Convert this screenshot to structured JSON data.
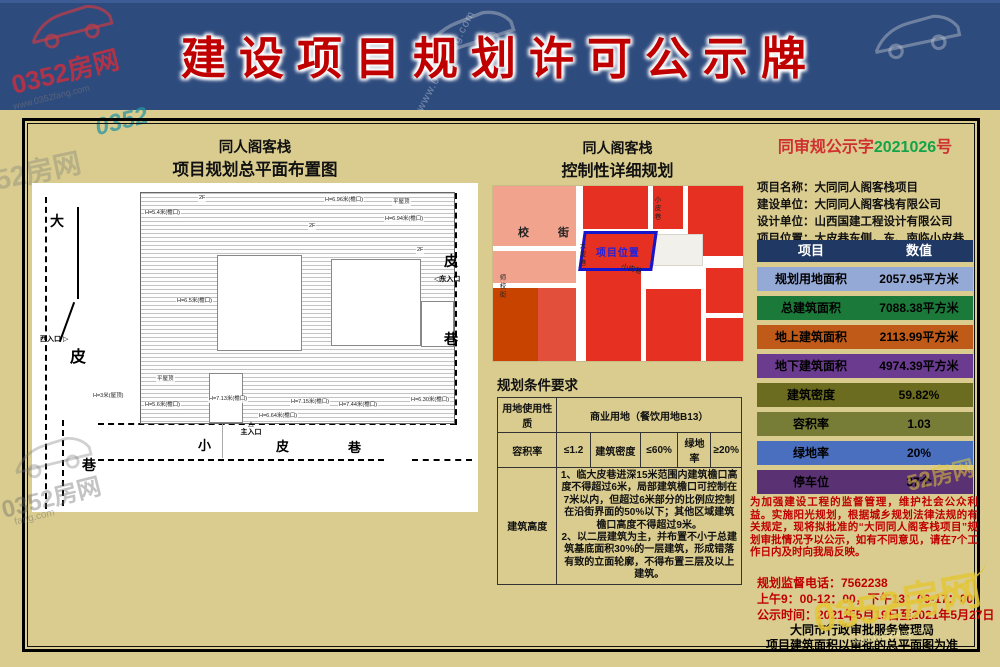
{
  "header": {
    "title": "建设项目规划许可公示牌"
  },
  "watermarks": {
    "brand": "0352房网",
    "domain": "www.0352fang.com",
    "short": "52房网",
    "logo": "0352",
    "suffix": "fang.com"
  },
  "left_panel": {
    "title_line1": "同人阁客栈",
    "title_line2": "项目规划总平面布置图",
    "streets": [
      "大",
      "皮",
      "巷",
      "皮",
      "巷",
      "小",
      "皮",
      "巷"
    ],
    "entrances": {
      "west": "西入口",
      "east": "东入口",
      "main": "主入口"
    },
    "icons": {
      "west_arrow": "▷",
      "east_arrow": "◁",
      "main_arrow": "△"
    },
    "annotations": [
      "H=5.4米(檐口)",
      "H=6.96米(檐口)",
      "H=6.94米(檐口)",
      "2F",
      "2F",
      "2F",
      "平屋顶",
      "平屋顶",
      "H=6.5米(檐口)",
      "H=3米(屋顶)",
      "H=5.6米(檐口)",
      "H=7.13米(檐口)",
      "H=7.15米(檐口)",
      "H=7.44米(檐口)",
      "H=6.30米(檐口)",
      "H=6.64米(檐口)"
    ]
  },
  "mid_panel": {
    "title_line1": "同人阁客栈",
    "title_line2": "控制性详细规划",
    "map_labels": {
      "school_street": "校　街",
      "shixiao_street": "师校街",
      "dapi_lane": "大皮巷",
      "xiaopi_lane_vertical": "小皮巷",
      "xiaopi_lane_diagonal": "小皮巷",
      "project_location": "项目位置"
    },
    "cond": {
      "title": "规划条件要求",
      "row1_label": "用地使用性质",
      "row1_value": "商业用地（餐饮用地B13）",
      "row2": [
        "容积率",
        "≤1.2",
        "建筑密度",
        "≤60%",
        "绿地率",
        "≥20%"
      ],
      "row3_label": "建筑高度",
      "row3_text": "1、临大皮巷进深15米范围内建筑檐口高度不得超过6米，局部建筑檐口可控制在7米以内，但超过6米部分的比例应控制在沿街界面的50%以下；其他区域建筑檐口高度不得超过9米。\n2、以二层建筑为主，并布置不小于总建筑基底面积30%的一层建筑，形成错落有致的立面轮廓，不得布置三层及以上建筑。"
    }
  },
  "right_panel": {
    "serial_prefix": "同审规公示字",
    "serial_number": "2021026",
    "serial_suffix": "号",
    "info_lines": [
      "项目名称：大同同人阁客栈项目",
      "建设单位：大同同人阁客栈有限公司",
      "设计单位：山西国建工程设计有限公司",
      "项目位置：大皮巷东侧，东、南临小皮巷"
    ],
    "table": {
      "header": [
        "项目",
        "数值"
      ],
      "rows": [
        {
          "label": "规划用地面积",
          "value": "2057.95平方米"
        },
        {
          "label": "总建筑面积",
          "value": "7088.38平方米"
        },
        {
          "label": "地上建筑面积",
          "value": "2113.99平方米"
        },
        {
          "label": "地下建筑面积",
          "value": "4974.39平方米"
        },
        {
          "label": "建筑密度",
          "value": "59.82%"
        },
        {
          "label": "容积率",
          "value": "1.03"
        },
        {
          "label": "绿地率",
          "value": "20%"
        },
        {
          "label": "停车位",
          "value": "37个"
        }
      ]
    },
    "notice": "为加强建设工程的监督管理，维护社会公众利益。实施阳光规划，根据城乡规划法律法规的有关规定，现将拟批准的“大同同人阁客栈项目”规划审批情况予以公示，如有不同意见，请在7个工作日内及时向我局反映。",
    "phone": "规划监督电话：7562238",
    "hours": "上午9：00-12：00，下午13：00-17：00",
    "period": "公示时间：2021年5月19日至2021年5月27日",
    "agency_line1": "大同市行政审批服务管理局",
    "agency_line2": "项目建筑面积以审批的总平面图为准"
  },
  "colors": {
    "board_bg": "#d9cc8e",
    "header_bg": "#2e4b7e",
    "title_red": "#c00000",
    "serial_red": "#d03030",
    "serial_green": "#12a44a",
    "table_header_bg": "#1f3864",
    "row_planning_area": "#94a9d6",
    "row_total_area": "#1b7a3a",
    "row_above_ground": "#c05a18",
    "row_below_ground": "#6a3b8f",
    "row_density": "#6b6c1f",
    "row_far": "#777c37",
    "row_green_rate": "#4a6fbf",
    "row_parking": "#5a3173",
    "map_red": "#e53022",
    "map_salmon": "#f2a38e",
    "map_dark_orange": "#c84300",
    "project_border_blue": "#1515cc",
    "notice_red": "#cc0000"
  }
}
